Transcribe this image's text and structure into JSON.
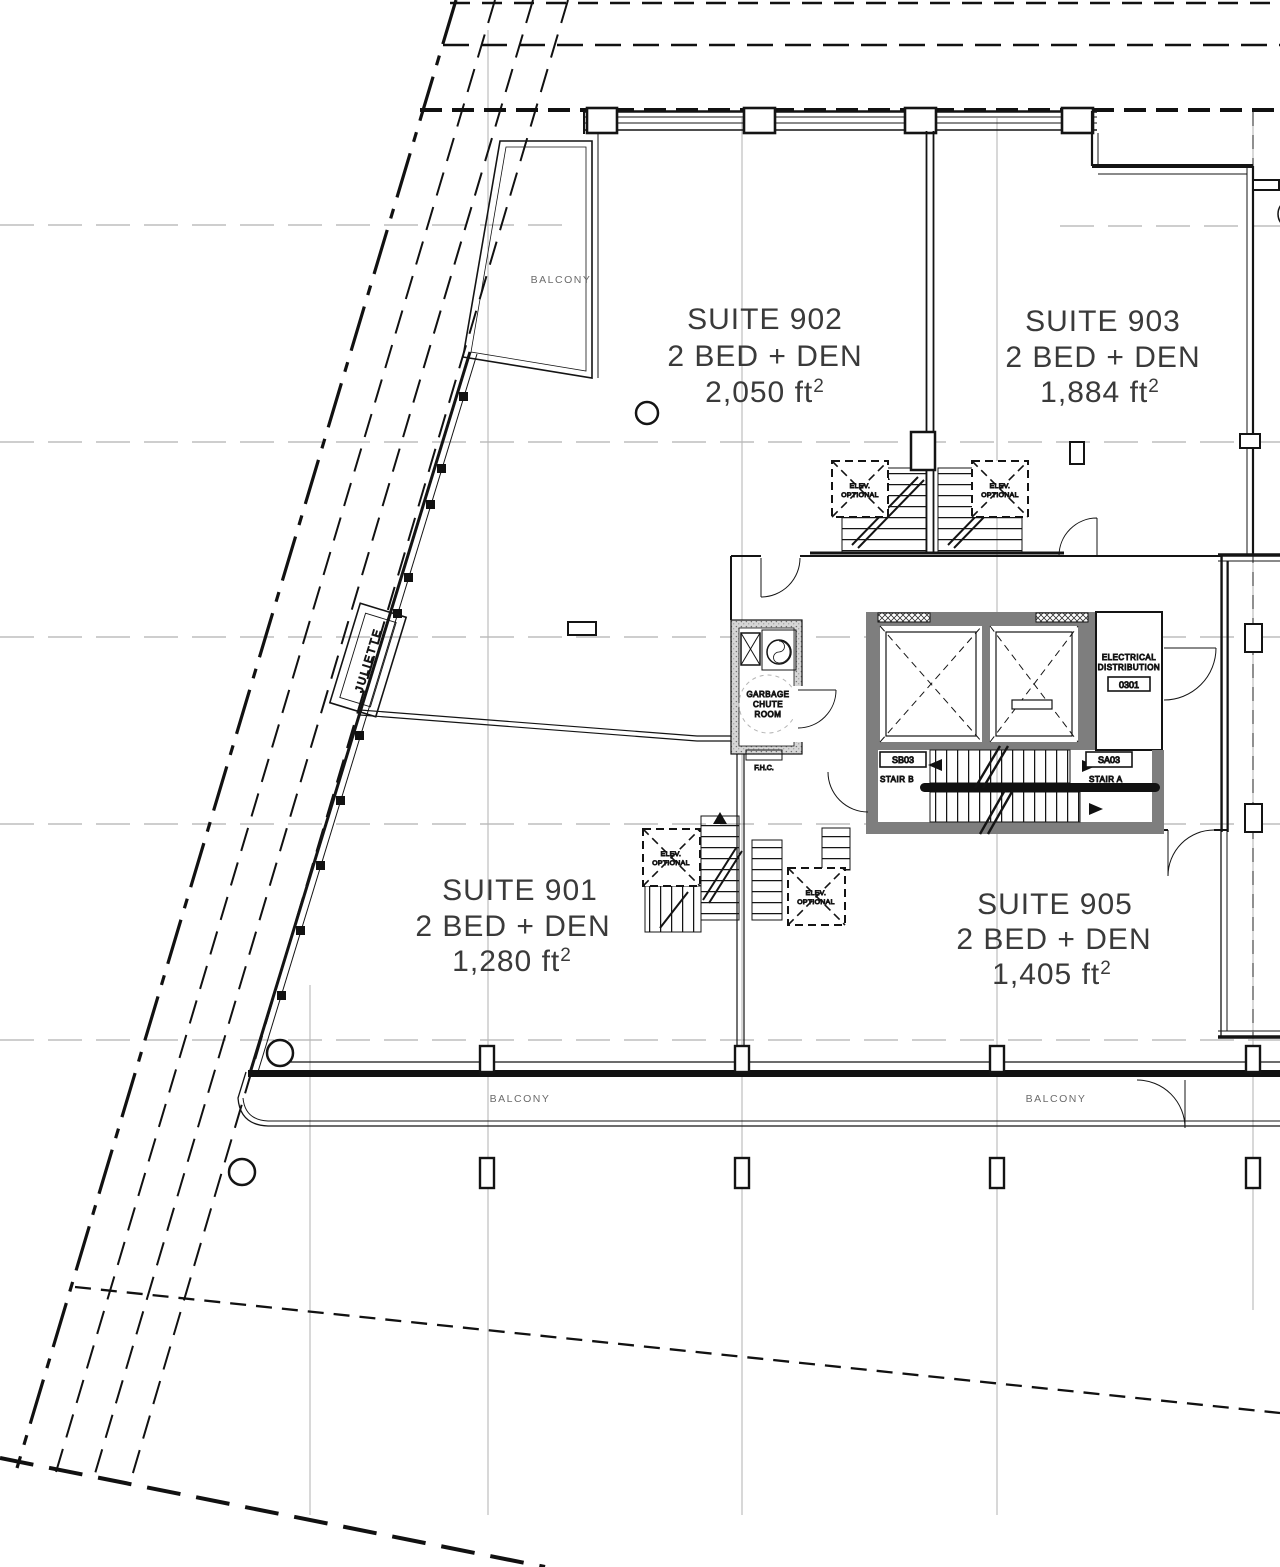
{
  "drawing": {
    "suites": [
      {
        "id": "902",
        "title": "SUITE 902",
        "type": "2 BED + DEN",
        "area": "2,050 ft",
        "area_sup": "2"
      },
      {
        "id": "903",
        "title": "SUITE 903",
        "type": "2 BED + DEN",
        "area": "1,884 ft",
        "area_sup": "2"
      },
      {
        "id": "901",
        "title": "SUITE 901",
        "type": "2 BED + DEN",
        "area": "1,280 ft",
        "area_sup": "2"
      },
      {
        "id": "905",
        "title": "SUITE 905",
        "type": "2 BED + DEN",
        "area": "1,405 ft",
        "area_sup": "2"
      }
    ],
    "labels": {
      "balcony": "BALCONY",
      "juliette": "JULIETTE",
      "garbage_line1": "GARBAGE",
      "garbage_line2": "CHUTE",
      "garbage_line3": "ROOM",
      "electrical_line1": "ELECTRICAL",
      "electrical_line2": "DISTRIBUTION",
      "electrical_tag": "0301",
      "stair_b_tag": "SB03",
      "stair_b": "STAIR B",
      "stair_a_tag": "SA03",
      "stair_a": "STAIR A",
      "fhc": "F.H.C.",
      "elev_line1": "ELEV.",
      "elev_line2": "OPTIONAL"
    },
    "colors": {
      "red": "#a8625e",
      "label_gray": "#6b6b6b",
      "light_gray": "#8f8f8f",
      "grid_gray": "#9c9c9c",
      "wall_gray": "#7e7e7e"
    }
  }
}
